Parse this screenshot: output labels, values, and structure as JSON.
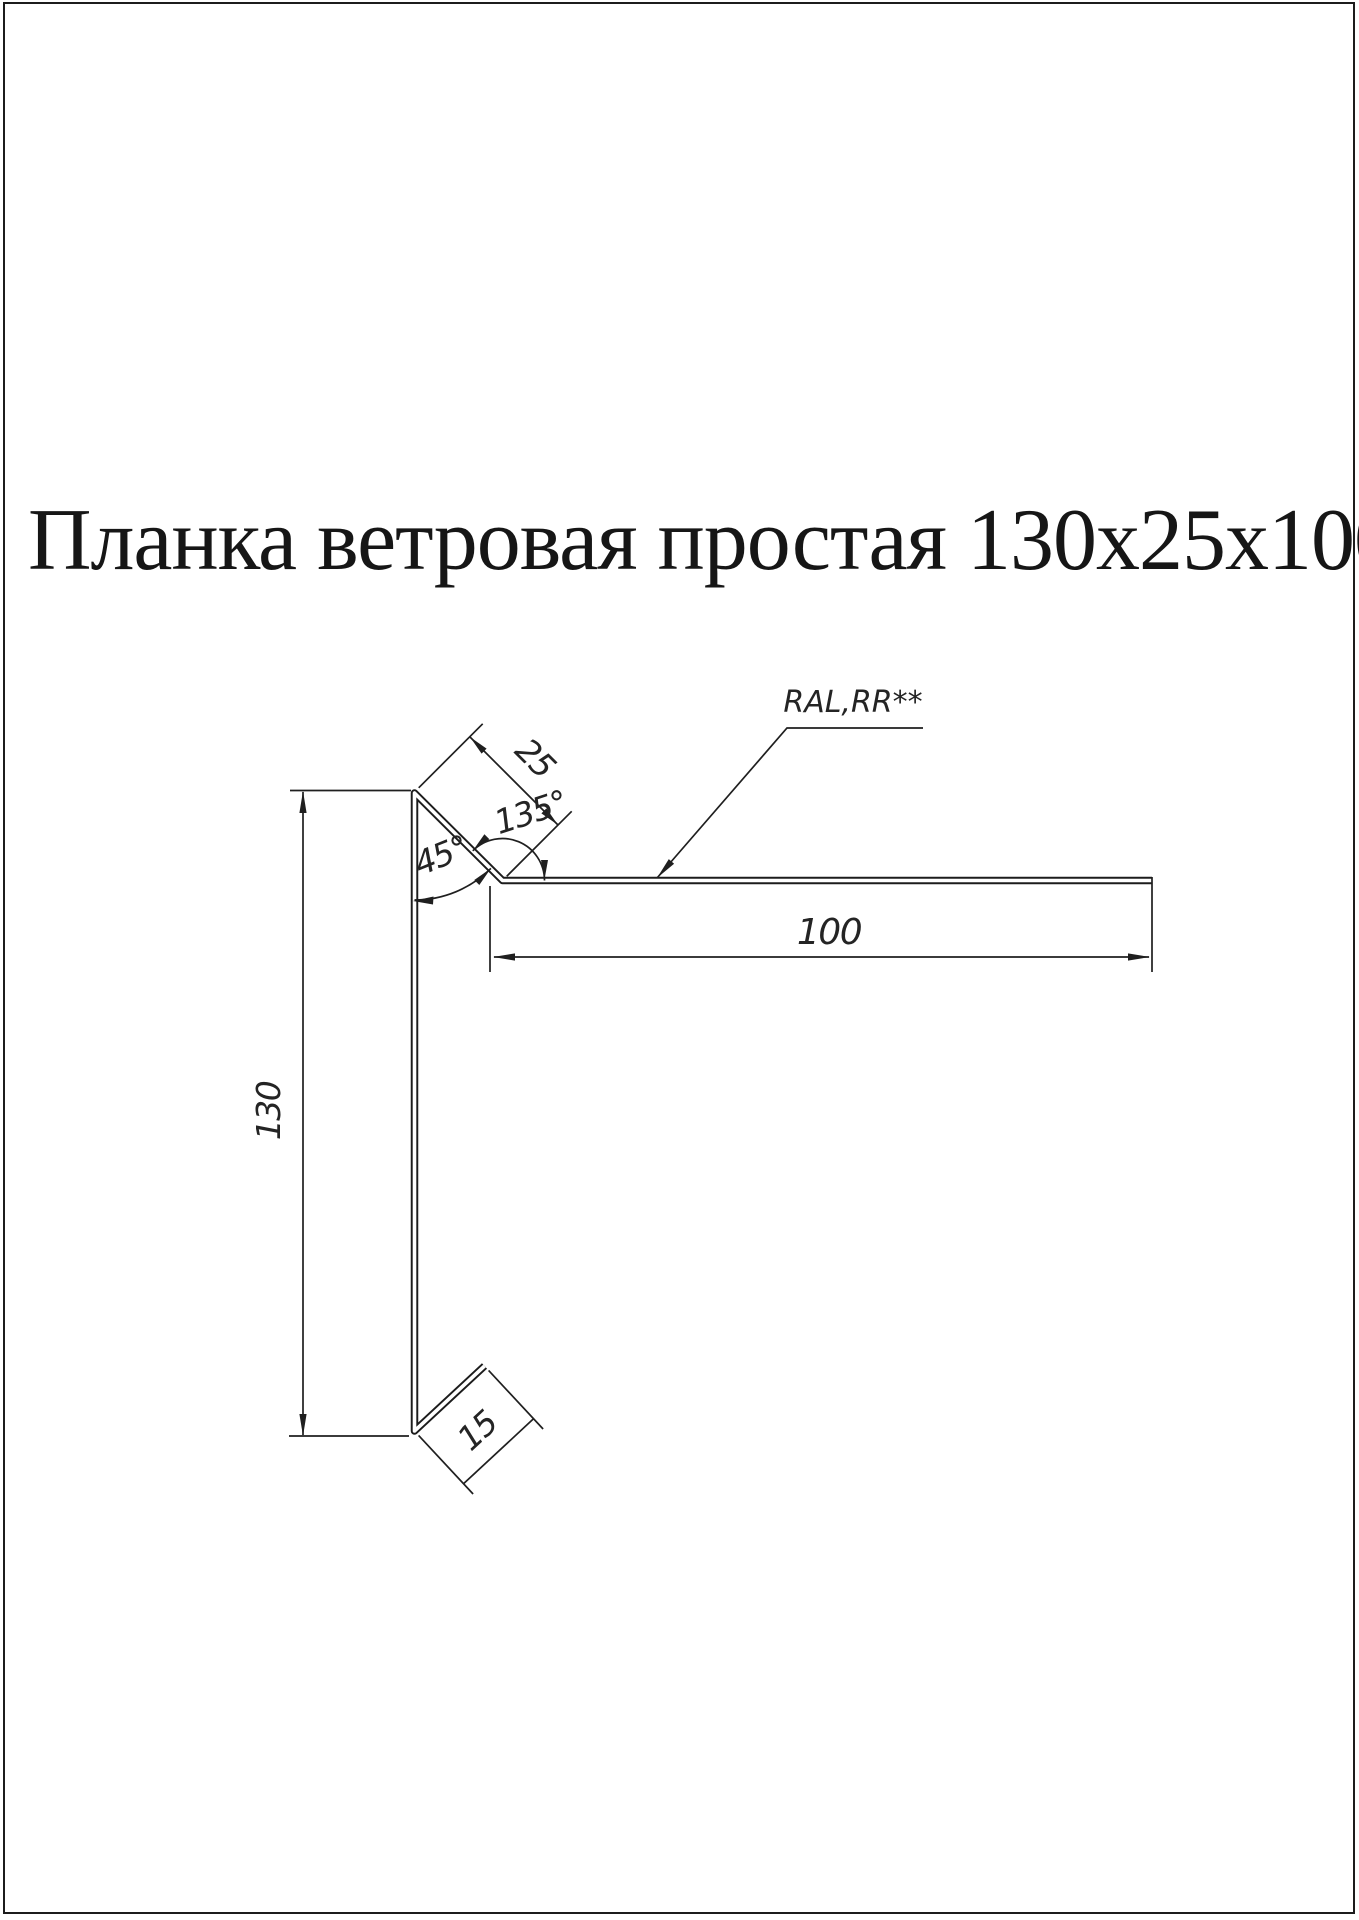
{
  "title": "Планка ветровая простая 130х25х100",
  "annotations": {
    "coating": "RAL,RR**"
  },
  "dims": {
    "height": "130",
    "top_flange": "25",
    "bend_angle": "135°",
    "fold_angle": "45°",
    "width": "100",
    "bottom_flange": "15"
  }
}
